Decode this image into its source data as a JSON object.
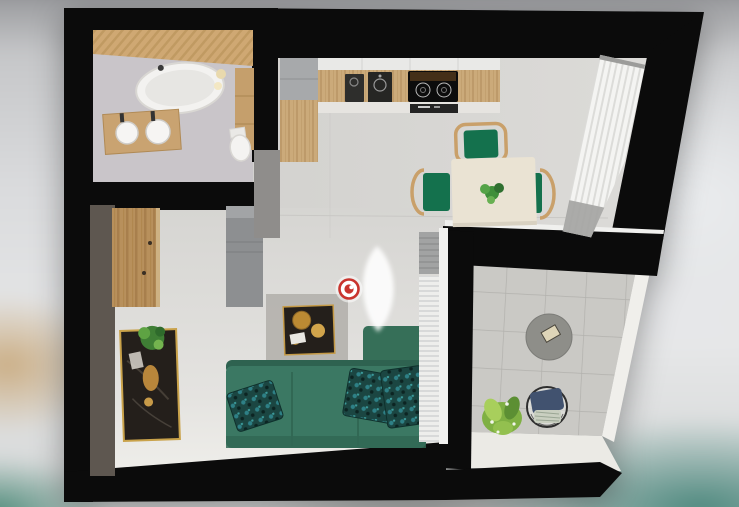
{
  "scene": {
    "kind": "3d-top-down-floorplan-render",
    "marker": {
      "name": "panorama-viewpoint-marker",
      "label": "360° viewpoint marker",
      "color": "#c9342e"
    }
  },
  "palette": {
    "walls": "#0b0b0b",
    "floor": "#d7d6d3",
    "floor-light": "#efeeea",
    "bath-floor": "#c9c5c9",
    "wood": "#cfa873",
    "wood-dark": "#b8905c",
    "counter-wood": "#cbaa7a",
    "cabinet-gray": "#a7a9ab",
    "wall-gray": "#95938f",
    "accent-wall": "#5a534d",
    "sofa-green": "#3b7863",
    "sofa-dark": "#2e6250",
    "pillow-teal": "#1b4642",
    "chair-green": "#14714d",
    "chair-frame": "#c9a06a",
    "table-cream": "#eae3d3",
    "tile-gray": "#cac9c5",
    "rail-white": "#f0efeb",
    "cushion-navy": "#41526f",
    "gold": "#c49a47",
    "marker-red": "#c9342e",
    "curtain-white": "#f4f4f2",
    "drape-gray": "#9c9c9a",
    "plant-green": "#3f8f3a",
    "plant-light": "#a8cf5c",
    "console-dark": "#241f1b",
    "appliance-black": "#0c0c0c"
  },
  "rooms": [
    {
      "id": "bathroom",
      "label": "Bathroom",
      "items": [
        "Bathtub",
        "Vanity with two sinks",
        "Toilet",
        "Wood slat wall",
        "Wall cabinet"
      ]
    },
    {
      "id": "hallway",
      "label": "Hallway",
      "items": [
        "Wardrobe",
        "Gray cabinet",
        "Console table with plant",
        "Dark accent wall"
      ]
    },
    {
      "id": "kitchen",
      "label": "Kitchen",
      "items": [
        "Wood counter",
        "Double sink",
        "Induction cooktop",
        "Oven",
        "Tall cabinets"
      ]
    },
    {
      "id": "dining",
      "label": "Dining area",
      "items": [
        "Dining table",
        "Green chairs",
        "Centerpiece plant",
        "Sheer curtain"
      ]
    },
    {
      "id": "living",
      "label": "Living room",
      "items": [
        "Green corner sofa",
        "Patterned pillows",
        "Coffee table with gold decor",
        "Radiator",
        "Window curtain"
      ]
    },
    {
      "id": "balcony",
      "label": "Balcony",
      "items": [
        "Round table",
        "Wire chair",
        "Ornamental grass",
        "White railing"
      ]
    }
  ]
}
